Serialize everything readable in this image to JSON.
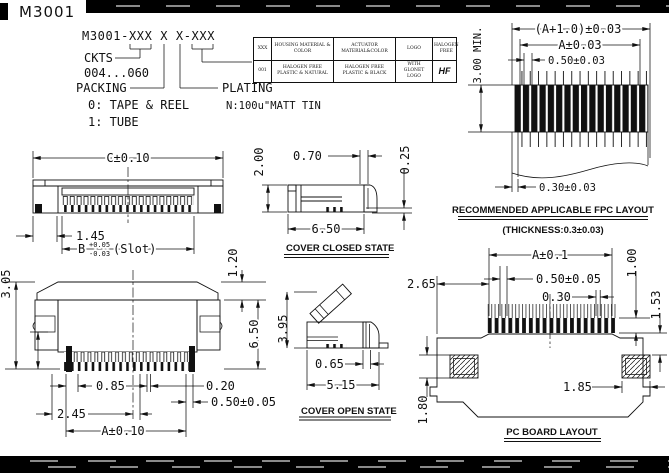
{
  "title": "M3001",
  "part_code": {
    "code": "M3001-XXX X X-XXX",
    "ckts_label": "CKTS",
    "ckts_range": "004...060",
    "packing_label": "PACKING",
    "packing_option_tape": "0: TAPE & REEL",
    "packing_option_tube": "1: TUBE",
    "plating_label": "PLATING",
    "plating_value": "N:100u\"MATT TIN"
  },
  "spec_table": {
    "headers": [
      "XXX",
      "HOUSING MATERIAL & COLOR",
      "ACTUATOR MATERIAL&COLOR",
      "LOGO",
      "HALOGEN FREE"
    ],
    "row": [
      "001",
      "HALOGEN FREE PLASTIC & NATURAL",
      "HALOGEN FREE PLASTIC & BLACK",
      "WITH GLONET LOGO",
      "HF"
    ]
  },
  "top_view": {
    "dim_width": "C±0.10",
    "dim_end": "1.45",
    "slot_base": "B",
    "slot_tol_plus": "+0.05",
    "slot_tol_minus": "-0.03",
    "slot_suffix": "(Slot)"
  },
  "cover_closed": {
    "caption": "COVER CLOSED STATE",
    "dim_height": "2.00",
    "dim_front": "0.70",
    "dim_lip": "0.25",
    "dim_depth": "6.50"
  },
  "front_view": {
    "dim_height": "3.05",
    "dim_top": "1.20",
    "dim_depth": "6.50",
    "dim_first_pitch": "0.85",
    "dim_contact_width": "0.20",
    "dim_tab_offset": "2.45",
    "dim_pitch": "0.50±0.05",
    "dim_span": "A±0.10"
  },
  "cover_open": {
    "caption": "COVER OPEN STATE",
    "dim_height": "3.95",
    "dim_pivot": "0.65",
    "dim_depth": "5.15"
  },
  "fpc_layout": {
    "caption": "RECOMMENDED APPLICABLE FPC LAYOUT",
    "subcaption": "(THICKNESS:0.3±0.03)",
    "dim_total": "(A+1.0)±0.03",
    "dim_span": "A±0.03",
    "dim_pitch": "0.50±0.03",
    "dim_height": "3.00 MIN.",
    "dim_finger": "0.30±0.03"
  },
  "pcb_layout": {
    "caption": "PC BOARD LAYOUT",
    "dim_edge": "2.65",
    "dim_span": "A±0.1",
    "dim_pitch": "0.50±0.05",
    "dim_pad_width": "0.30",
    "dim_pad_length": "1.00",
    "dim_pad_offset": "1.53",
    "dim_anchor_width": "1.85",
    "dim_anchor_height": "1.80"
  }
}
